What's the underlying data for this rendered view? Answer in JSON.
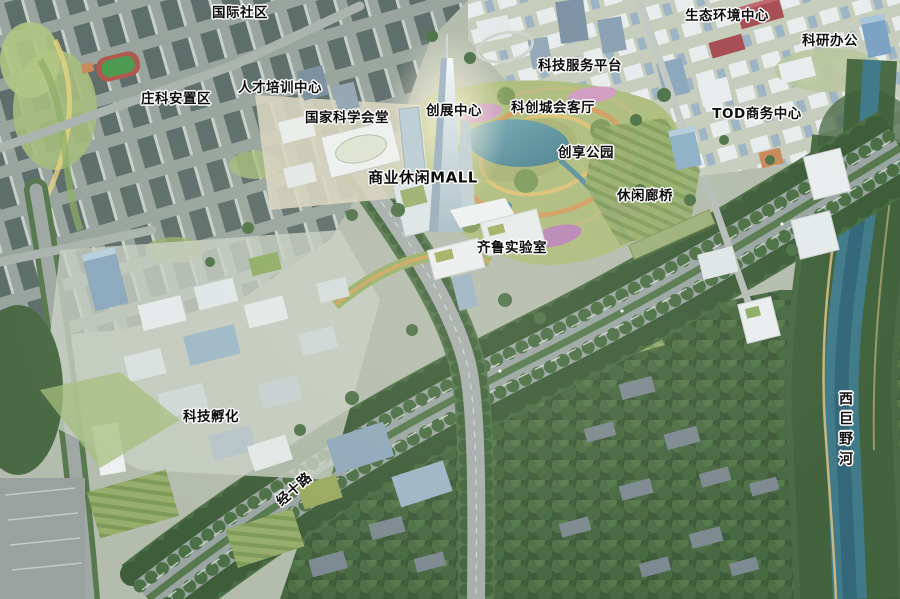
{
  "labels": [
    {
      "text": "国际社区"
    },
    {
      "text": "生态环境中心"
    },
    {
      "text": "科研办公"
    },
    {
      "text": "科技服务平台"
    },
    {
      "text": "人才培训中心"
    },
    {
      "text": "庄科安置区"
    },
    {
      "text": "科创城会客厅"
    },
    {
      "text": "创展中心"
    },
    {
      "text": "TOD商务中心"
    },
    {
      "text": "国家科学会堂"
    },
    {
      "text": "创享公园"
    },
    {
      "text": "商业休闲MALL"
    },
    {
      "text": "休闲廊桥"
    },
    {
      "text": "齐鲁实验室"
    },
    {
      "text": "科技孵化"
    },
    {
      "text": "经十路"
    },
    {
      "text": "西巨野河"
    }
  ],
  "palette": {
    "label_text": "#0d0d0d",
    "label_halo": "#ffffff",
    "road_grey": "#9aa5a3",
    "forest_green": "#3f5c3b",
    "park_green": "#96ad6c",
    "lake_teal": "#5f99a6",
    "river_water": "#417b8a",
    "building_red": "#a84e55",
    "glass_blue": "#8ba8bd"
  }
}
